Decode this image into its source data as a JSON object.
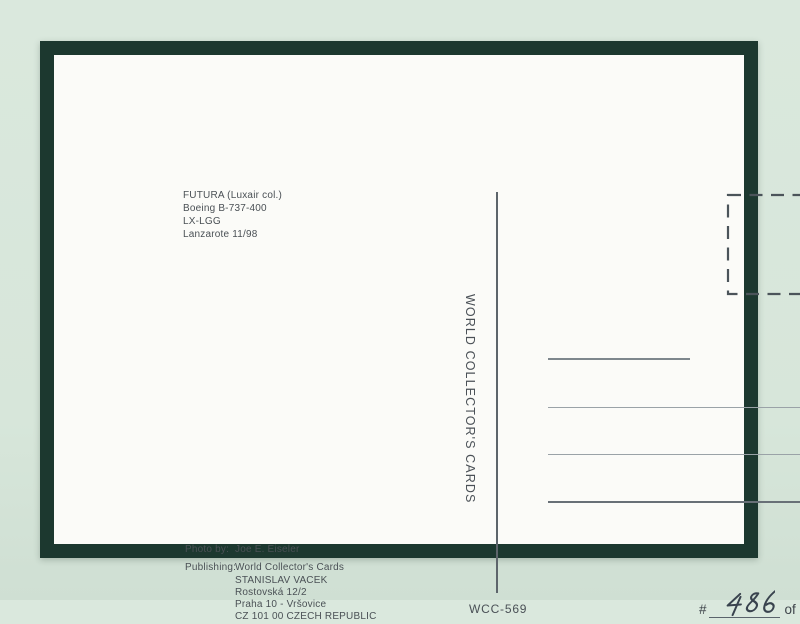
{
  "postcard": {
    "aircraft": {
      "lines": [
        "FUTURA (Luxair col.)",
        "Boeing B-737-400",
        "LX-LGG",
        "Lanzarote 11/98"
      ]
    },
    "brand_vertical": "WORLD COLLECTOR'S CARDS",
    "credits": {
      "photo_label": "Photo by:",
      "photo_value": "Joe E. Eiseler",
      "publishing_label": "Publishing:",
      "publishing_lines": [
        "World Collector's Cards",
        "STANISLAV VACEK",
        "Rostovská 12/2",
        "Praha 10 - Vršovice",
        "CZ 101 00 CZECH REPUBLIC"
      ]
    },
    "code": "WCC-569",
    "edition": {
      "prefix": "#",
      "number": "486",
      "suffix": "of 600"
    },
    "colors": {
      "background": "#d8e7db",
      "frame": "#1c382f",
      "card": "#fbfbf8",
      "ink": "#4a5055",
      "handwriting": "#39434e"
    }
  }
}
